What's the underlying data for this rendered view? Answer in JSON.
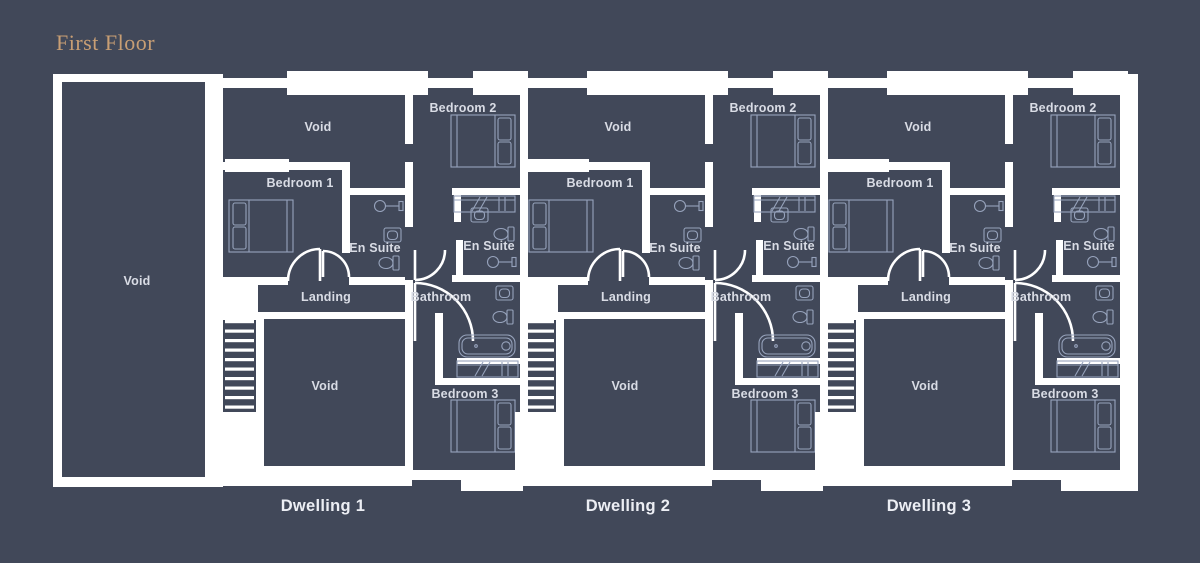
{
  "title": "First Floor",
  "plan": {
    "left_void_label": "Void",
    "room_labels": {
      "void_upper": "Void",
      "bedroom_1": "Bedroom 1",
      "en_suite_1": "En Suite",
      "bedroom_2": "Bedroom 2",
      "en_suite_2": "En Suite",
      "landing": "Landing",
      "bathroom": "Bathroom",
      "void_lower": "Void",
      "bedroom_3": "Bedroom 3"
    },
    "dwellings": [
      {
        "name": "Dwelling 1"
      },
      {
        "name": "Dwelling 2"
      },
      {
        "name": "Dwelling 3"
      }
    ]
  },
  "colors": {
    "background": "#414859",
    "walls": "#ffffff",
    "fixture_lines": "#97a3bc",
    "room_label_text": "#d9dce5",
    "dwelling_label_text": "#eceef4",
    "title_text": "#c89e74"
  }
}
